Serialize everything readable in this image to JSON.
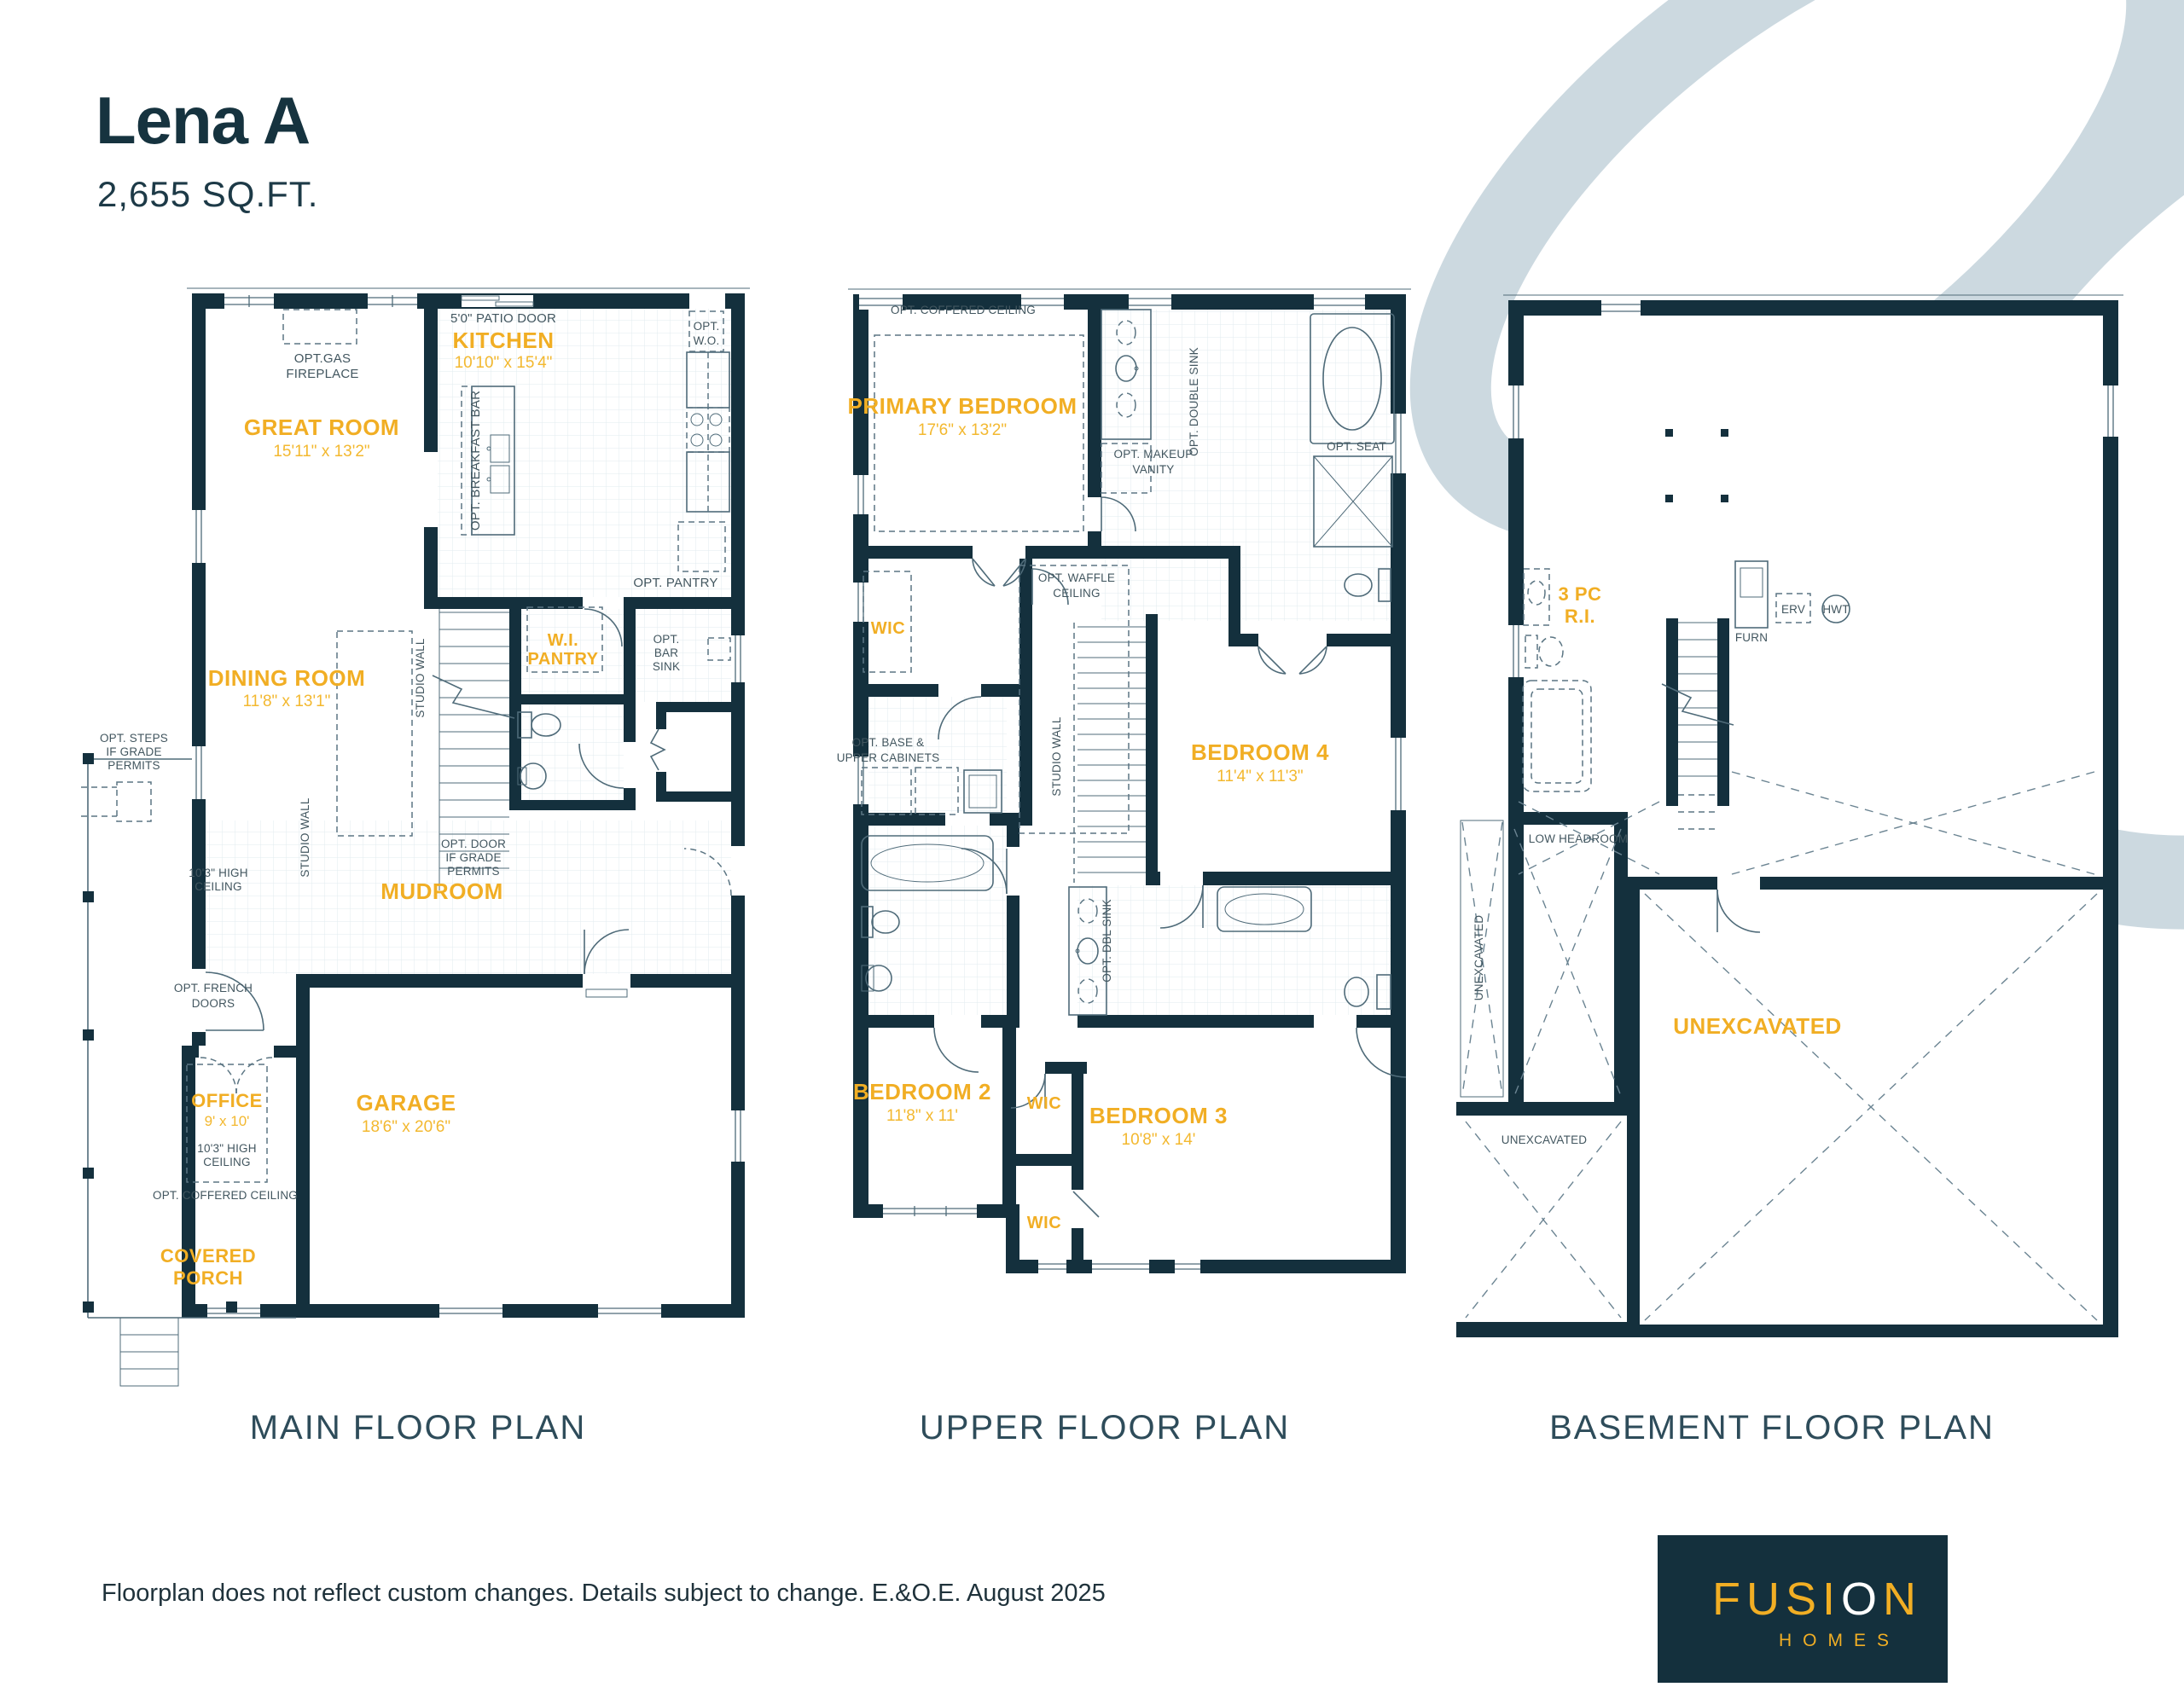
{
  "header": {
    "title": "Lena A",
    "sqft": "2,655 SQ.FT."
  },
  "shared": {
    "studio_wall": "STUDIO WALL",
    "opt_coffered": "OPT. COFFERED CEILING",
    "unexcavated": "UNEXCAVATED",
    "high_ceiling": [
      "10'3\" HIGH",
      "CEILING"
    ]
  },
  "plans": {
    "main": {
      "caption": "MAIN FLOOR PLAN",
      "rooms": {
        "great_room": {
          "name": "GREAT ROOM",
          "dims": "15'11\" x 13'2\""
        },
        "dining_room": {
          "name": "DINING ROOM",
          "dims": "11'8\" x 13'1\""
        },
        "kitchen": {
          "name": "KITCHEN",
          "dims": "10'10\" x 15'4\""
        },
        "wi_pantry": [
          "W.I.",
          "PANTRY"
        ],
        "mudroom": "MUDROOM",
        "office": {
          "name": "OFFICE",
          "dims": "9' x 10'"
        },
        "garage": {
          "name": "GARAGE",
          "dims": "18'6\" x 20'6\""
        },
        "covered_porch": [
          "COVERED",
          "PORCH"
        ]
      },
      "notes": {
        "opt_gas": [
          "OPT.GAS",
          "FIREPLACE"
        ],
        "patio_door": "5'0\" PATIO DOOR",
        "opt_wo": [
          "OPT.",
          "W.O."
        ],
        "breakfast_bar": "OPT. BREAKFAST BAR",
        "opt_pantry": "OPT. PANTRY",
        "opt_bar_sink": [
          "OPT.",
          "BAR",
          "SINK"
        ],
        "opt_steps": [
          "OPT. STEPS",
          "IF GRADE",
          "PERMITS"
        ],
        "opt_door": [
          "OPT. DOOR",
          "IF GRADE",
          "PERMITS"
        ],
        "opt_french": [
          "OPT. FRENCH",
          "DOORS"
        ]
      }
    },
    "upper": {
      "caption": "UPPER FLOOR PLAN",
      "rooms": {
        "primary": {
          "name": "PRIMARY BEDROOM",
          "dims": "17'6\" x 13'2\""
        },
        "bedroom2": {
          "name": "BEDROOM 2",
          "dims": "11'8\" x 11'"
        },
        "bedroom3": {
          "name": "BEDROOM 3",
          "dims": "10'8\" x 14'"
        },
        "bedroom4": {
          "name": "BEDROOM 4",
          "dims": "11'4\" x 11'3\""
        },
        "wic": "WIC"
      },
      "notes": {
        "double_sink": "OPT. DOUBLE SINK",
        "makeup_vanity": [
          "OPT. MAKEUP",
          "VANITY"
        ],
        "opt_seat": "OPT. SEAT",
        "waffle": [
          "OPT. WAFFLE",
          "CEILING"
        ],
        "base_cabinets": [
          "OPT. BASE &",
          "UPPER CABINETS"
        ],
        "dbl_sink": "OPT. DBL SINK"
      }
    },
    "basement": {
      "caption": "BASEMENT FLOOR PLAN",
      "labels": {
        "three_pc": [
          "3 PC",
          "R.I."
        ],
        "furn": "FURN",
        "erv": "ERV",
        "hwt": "HWT",
        "low_headroom": "LOW HEADROOM"
      }
    }
  },
  "footer": {
    "disclaimer": "Floorplan does not reflect custom changes. Details subject to change. E.&O.E. August 2025"
  },
  "logo": {
    "brand_part1": "FUSI",
    "brand_part2": "O",
    "brand_part3": "N",
    "subtext": "HOMES"
  },
  "colors": {
    "navy": "#14303d",
    "yellow": "#f1ae24",
    "annotation": "#42565f",
    "swoosh": "#ccd9e0"
  }
}
